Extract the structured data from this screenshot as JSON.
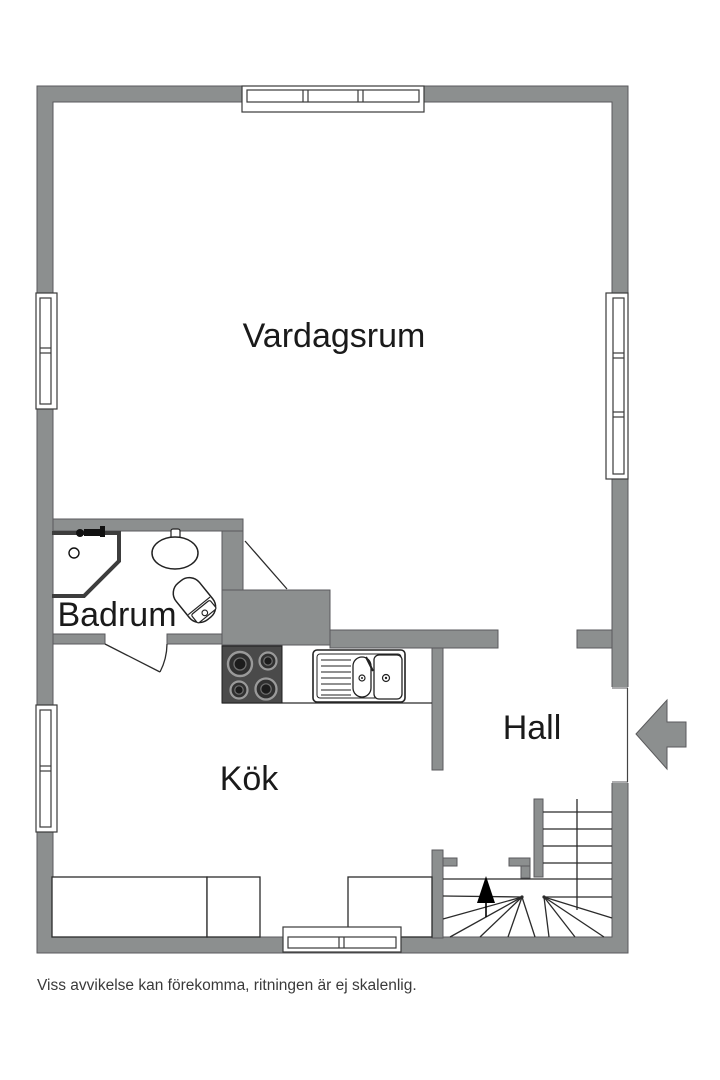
{
  "floor_plan": {
    "rooms": [
      {
        "id": "vardagsrum",
        "label": "Vardagsrum"
      },
      {
        "id": "badrum",
        "label": "Badrum"
      },
      {
        "id": "kok",
        "label": "Kök"
      },
      {
        "id": "hall",
        "label": "Hall"
      }
    ],
    "icons": [
      "entrance-arrow",
      "stairs-up-arrow",
      "stove",
      "kitchen-sink",
      "washbasin",
      "toilet",
      "shower",
      "window",
      "door-swing"
    ],
    "colors": {
      "wall": "#8c8f8f",
      "wall_outline": "#5a5a5c",
      "line": "#2b2b2b",
      "stove": "#4a4a4a",
      "text": "#1a1a1a",
      "background": "#ffffff"
    }
  },
  "disclaimer": "Viss avvikelse kan förekomma, ritningen är ej skalenlig."
}
